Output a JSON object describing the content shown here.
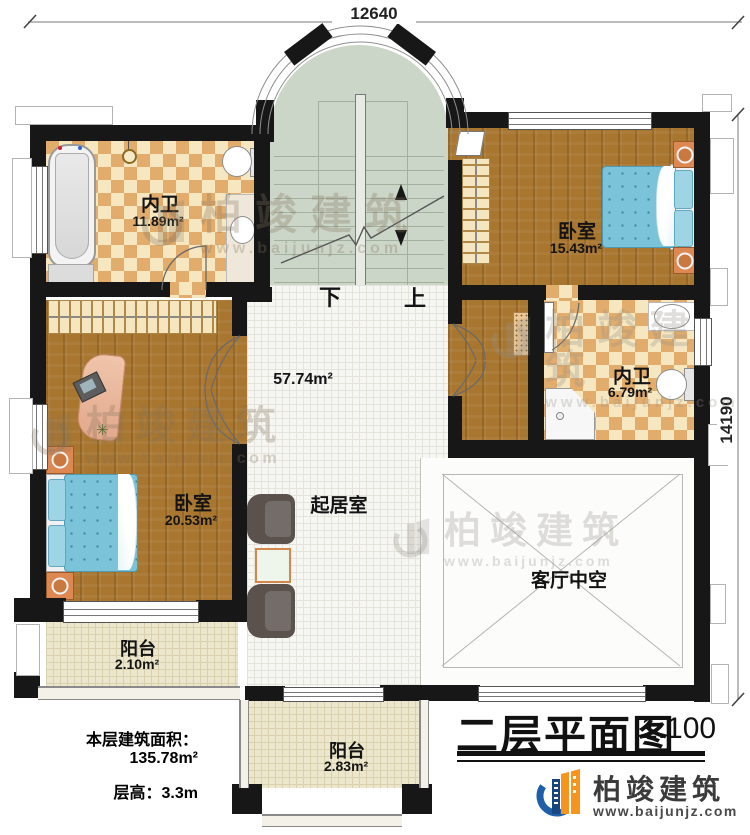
{
  "dimensions": {
    "width_label": "12640",
    "height_label": "14190"
  },
  "rooms": {
    "bath_top": {
      "name": "内卫",
      "area": "11.89m²"
    },
    "bedroom_right": {
      "name": "卧室",
      "area": "15.43m²"
    },
    "bath_right": {
      "name": "内卫",
      "area": "6.79m²"
    },
    "bedroom_left": {
      "name": "卧室",
      "area": "20.53m²"
    },
    "living": {
      "name": "起居室",
      "area": "57.74m²"
    },
    "void": {
      "name": "客厅中空"
    },
    "balcony_left": {
      "name": "阳台",
      "area": "2.10m²"
    },
    "balcony_bottom": {
      "name": "阳台",
      "area": "2.83m²"
    }
  },
  "stairs": {
    "down": "下",
    "up": "上"
  },
  "info": {
    "area_label": "本层建筑面积：",
    "area_value": "135.78m²",
    "height_label": "层高：",
    "height_value": "3.3m"
  },
  "titleblock": {
    "title": "二层平面图",
    "scale": "1:100"
  },
  "brand": {
    "name": "柏竣建筑",
    "url": "www.baijunjz.com"
  },
  "icons": {
    "plant": "✳"
  },
  "colors": {
    "wall": "#171717",
    "wood": "#a8762f",
    "checker_dark": "#e2ad6c",
    "stair": "#ccd6c8",
    "tile": "#f6f6f3",
    "balcony": "#ece6cd",
    "bed_blue": "#7ac3d9",
    "logo_blue": "#1f5fa8",
    "logo_orange": "#f7941d"
  }
}
